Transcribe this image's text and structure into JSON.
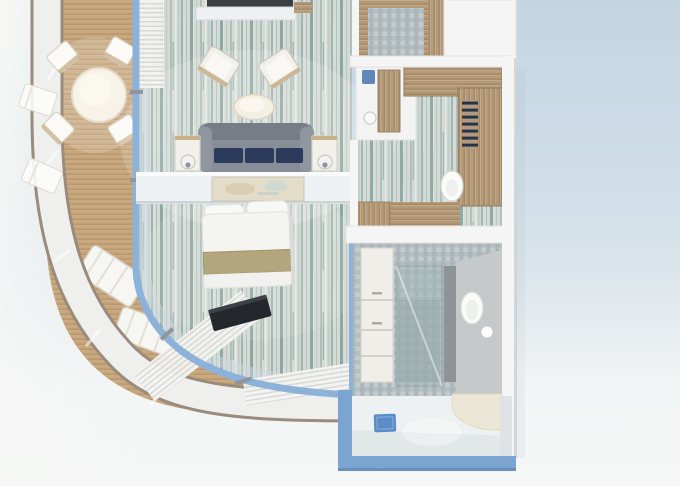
{
  "meta": {
    "description": "3D rendered top-down floor plan of a cruise ship balcony suite stateroom",
    "width_px": 680,
    "height_px": 486,
    "visible_text": ""
  },
  "colors": {
    "bg-top": "#c4d5e2",
    "bg-bottom": "#f5f7f6",
    "bg-left": "#f8f8f6",
    "hull-edge": "#9b8b7c",
    "hull-fill": "#eff0ee",
    "deck-base": "#c9a87e",
    "deck-stripe": "#b6956c",
    "frame-blue": "#8db2d9",
    "frame-blue-dark": "#6f97c4",
    "glass-tint": "#cfdae0",
    "mullion-gray": "#8f959a",
    "carpet-base": "#d5dad6",
    "carpet-teal": "#6f958e",
    "carpet-teal-light": "#9db8b1",
    "carpet-white": "#e9ebe7",
    "curtain-light": "#f4f4f2",
    "curtain-dark": "#d8d9d7",
    "sofa-gray": "#878e97",
    "sofa-gray-dark": "#767d87",
    "cushion-navy": "#2c3a5c",
    "furn-white": "#f1f0ea",
    "furn-trim": "#cdc7b6",
    "wood": "#b49a79",
    "wood-dark": "#9c8263",
    "wood-light": "#c8b18c",
    "bed-white": "#f4f4f1",
    "bed-gold": "#b4a67c",
    "bed-gold-dark": "#a2946c",
    "pillow-white": "#f8f8f6",
    "tv-dark": "#24282c",
    "mosaic-base": "#b5bec1",
    "mosaic-dark": "#a9b3b6",
    "mosaic-light": "#c3cccf",
    "shower-teal": "#9fb9b3",
    "gray-wall": "#8e9397",
    "vanity-cream": "#efeee8",
    "toilet-white": "#fbfbf9",
    "entry-floor": "#eef1f2",
    "entry-blue": "#7ca4d1",
    "mat-blue": "#5b8cc8",
    "wall-white": "#f4f5f4",
    "wall-edge": "#d8dad8",
    "nook-cream": "#ece6d6",
    "shelf-navy": "#26344f",
    "chair-blue": "#5f87b8"
  },
  "scene": {
    "rooms": [
      {
        "name": "balcony",
        "objects": [
          "round-table",
          "balcony-chairs",
          "lounge-chairs",
          "teak-deck",
          "glass-railing"
        ]
      },
      {
        "name": "living-bedroom",
        "objects": [
          "sofa",
          "navy-cushions",
          "side-tables",
          "lamps",
          "armchairs",
          "oval-table",
          "console-desk",
          "map-art",
          "bed",
          "pillows",
          "gold-runner",
          "tv",
          "curtains",
          "striped-carpet",
          "wall-shelf"
        ]
      },
      {
        "name": "dressing-room",
        "objects": [
          "vanity-desk",
          "blue-chair",
          "stool",
          "wardrobe-cabinets",
          "navy-shelves",
          "toilet",
          "wood-floor"
        ]
      },
      {
        "name": "bathroom",
        "objects": [
          "vanity-drawers",
          "glass-shower",
          "partition-wall",
          "toilet",
          "mosaic-tiles"
        ]
      },
      {
        "name": "entrance-hall",
        "objects": [
          "white-floor",
          "blue-door-mat",
          "curved-nook",
          "blue-outer-wall"
        ]
      }
    ],
    "structure": [
      "ship-hull-band",
      "window-wall-blue-frame",
      "white-module-walls"
    ]
  }
}
